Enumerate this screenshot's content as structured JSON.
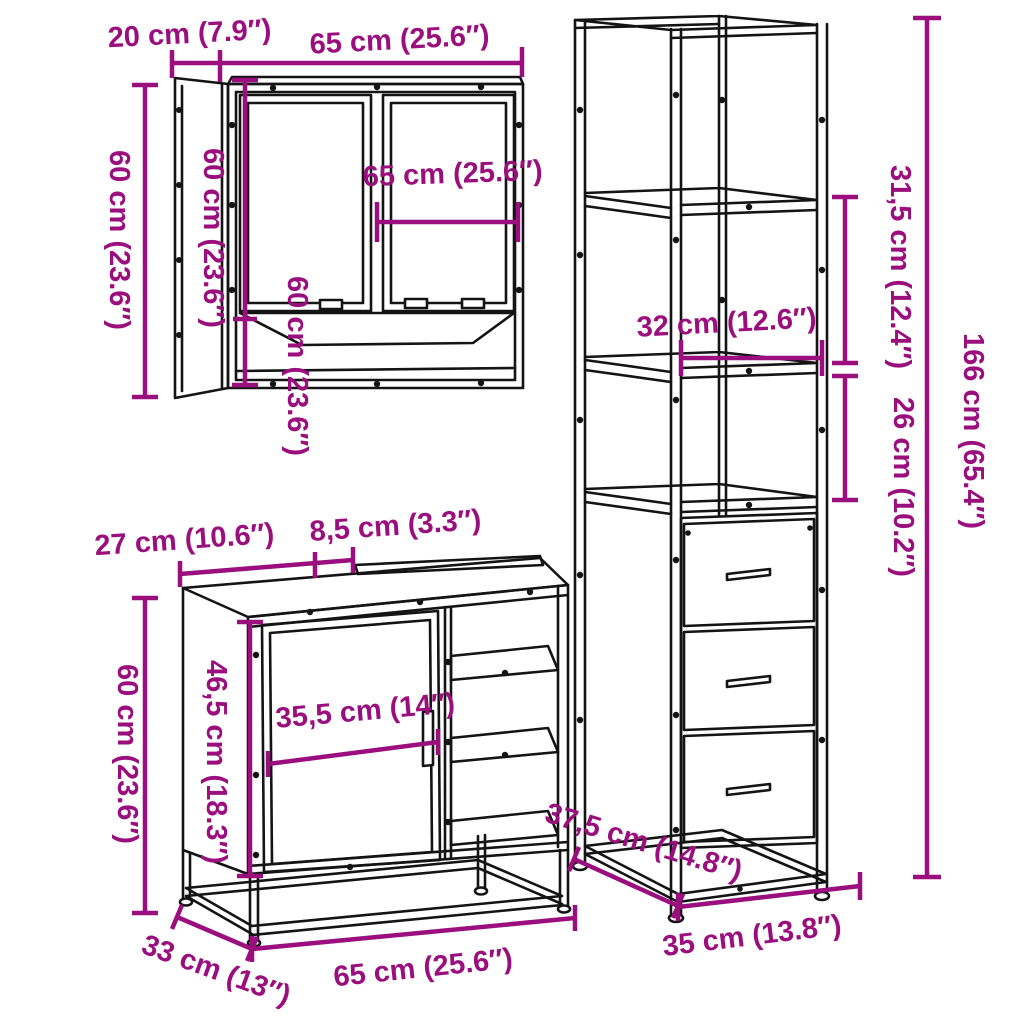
{
  "colors": {
    "dimension": "#9A0F7D",
    "line": "#141414",
    "background": "#FFFFFF"
  },
  "dims": {
    "mirror_cabinet": {
      "depth_top": "20 cm (7.9″)",
      "width_top": "65 cm (25.6″)",
      "height_outer": "60 cm (23.6″)",
      "height_side_panel": "60 cm (23.6″)",
      "height_inner": "60 cm (23.6″)",
      "width_inner": "65 cm (25.6″)"
    },
    "tall_cabinet": {
      "shelf_width": "32 cm (12.6″)",
      "upper_section_height": "31,5 cm (12.4″)",
      "middle_section_height": "26 cm (10.2″)",
      "total_height": "166 cm (65.4″)",
      "base_width": "35 cm (13.8″)",
      "base_depth": "37,5 cm (14.8″)"
    },
    "vanity_cabinet": {
      "top_depth": "27 cm (10.6″)",
      "top_recess": "8,5 cm (3.3″)",
      "total_height": "60 cm (23.6″)",
      "door_height": "46,5 cm (18.3″)",
      "door_width": "35,5 cm (14″)",
      "base_depth": "33 cm (13″)",
      "base_width": "65 cm (25.6″)"
    }
  }
}
